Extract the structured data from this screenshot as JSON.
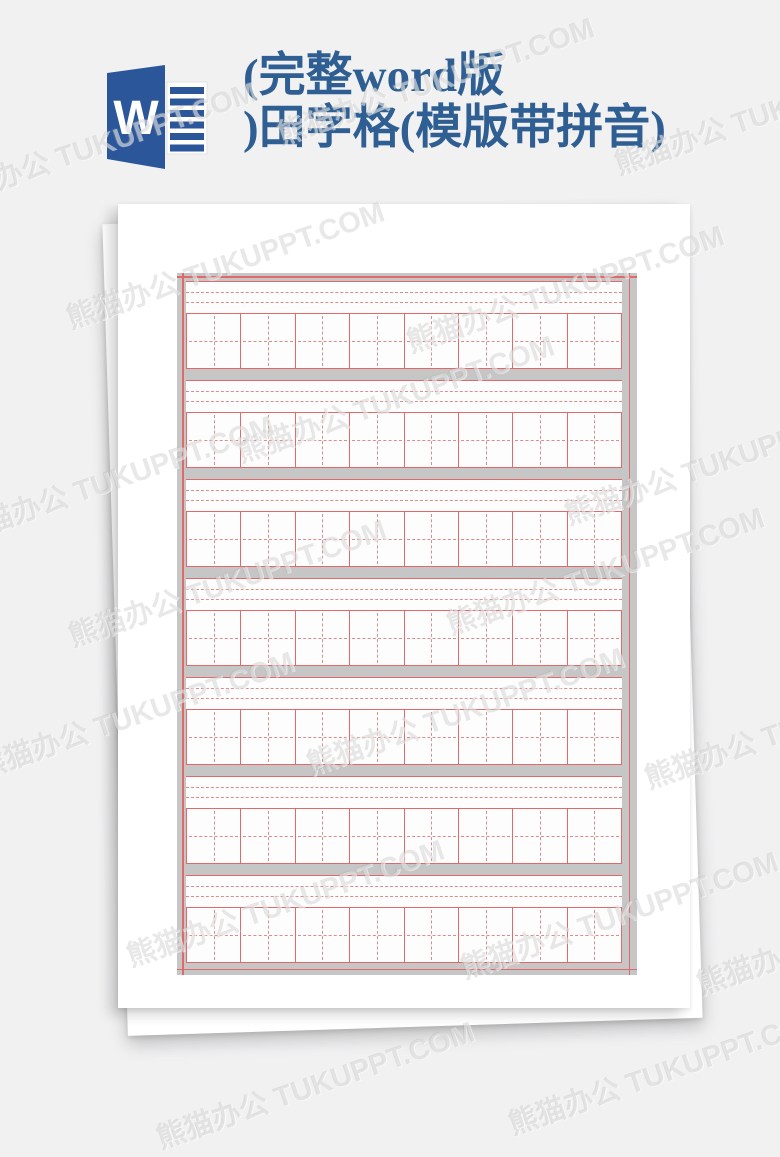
{
  "watermark": {
    "text": "熊猫办公 TUKUPPT.COM"
  },
  "header": {
    "title_line1": "(完整word版",
    "title_line2": ")田字格(模版带拼音)",
    "word_icon_letter": "W"
  },
  "document_preview": {
    "visible_sheet_count": 2,
    "practice_grid": {
      "row_count": 7,
      "columns_per_row": 8,
      "pinyin_dashed_lines_per_row": 2,
      "colors": {
        "grid_line_red": "#e06a6a",
        "grid_dashed_pink": "#dd8c8c",
        "band_gray": "#c5c6c5",
        "cell_fill": "#fdfdfd"
      }
    }
  },
  "colors": {
    "word_brand_blue": "#2b579a",
    "title_blue": "#2f5f92",
    "page_background": "#f1f1f2",
    "paper_white": "#ffffff"
  }
}
